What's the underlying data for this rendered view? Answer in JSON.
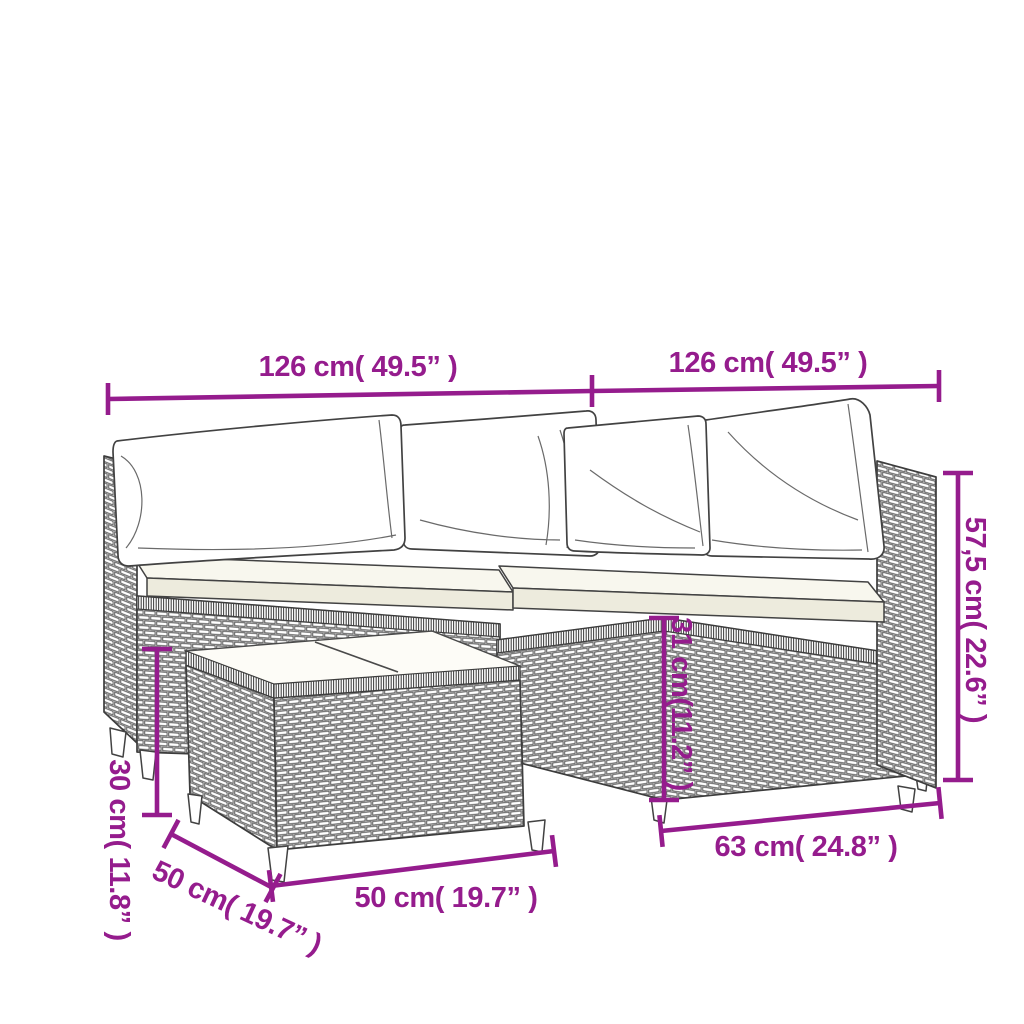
{
  "page": {
    "background_color": "#ffffff",
    "accent_color": "#951c8d",
    "description": "Line-art dimension diagram of a poly rattan garden lounge set: corner sofa with back pillows and seat cushions plus a square coffee table"
  },
  "dimensions": {
    "sofa_left_width": {
      "label": "126 cm( 49.5” )"
    },
    "sofa_right_width": {
      "label": "126 cm( 49.5” )"
    },
    "backrest_height": {
      "label": "57,5 cm( 22.6” )"
    },
    "seat_height": {
      "label": "31 cm(11.2” )"
    },
    "seat_depth": {
      "label": "63 cm( 24.8” )"
    },
    "table_width": {
      "label": "50 cm( 19.7” )"
    },
    "table_depth": {
      "label": "50 cm( 19.7” )"
    },
    "table_height": {
      "label": "30 cm( 11.8” )"
    }
  }
}
